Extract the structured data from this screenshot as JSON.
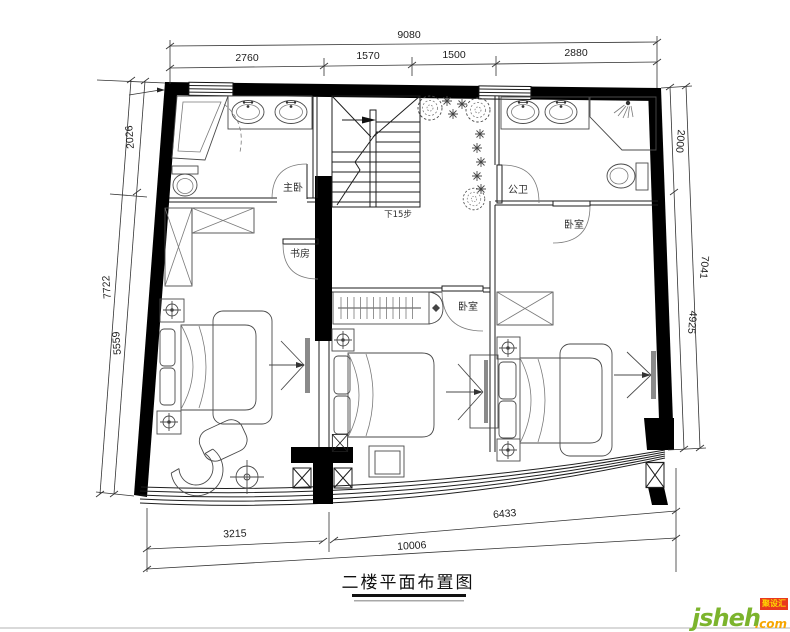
{
  "title": "二楼平面布置图",
  "labels": {
    "master_bedroom": "主卧",
    "study": "书房",
    "public_bath": "公卫",
    "bedroom_right": "卧室",
    "bedroom_mid": "卧室",
    "stairs_note": "下15步"
  },
  "dimensions": {
    "top_total": "9080",
    "top_segments": [
      "2760",
      "1570",
      "1500",
      "2880"
    ],
    "left_upper": "2026",
    "left_total": "7722",
    "left_lower": "5559",
    "right_upper": "2000",
    "right_total": "7041",
    "right_lower": "4925",
    "bottom_left": "3215",
    "bottom_right": "6433",
    "bottom_total": "10006"
  },
  "watermark": {
    "brand": "jsheh",
    "suffix": ".com",
    "badge": "聚设汇"
  },
  "colors": {
    "wall": "#000000",
    "line": "#1e1e1e",
    "brand_green": "#7cb42d",
    "brand_orange": "#f7a600",
    "badge_red": "#e8391d",
    "badge_text": "#ffd800"
  }
}
